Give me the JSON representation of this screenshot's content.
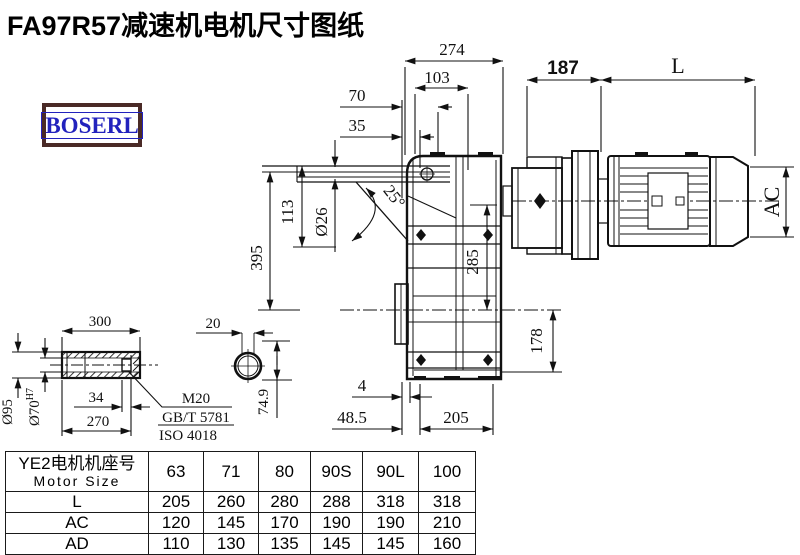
{
  "title": "FA97R57减速机电机尺寸图纸",
  "logo": {
    "text": "BOSERL"
  },
  "dims": {
    "d274": "274",
    "d103": "103",
    "d70": "70",
    "d35": "35",
    "d187": "187",
    "dL": "L",
    "dAC": "AC",
    "d395": "395",
    "d113": "113",
    "d26": "Ø26",
    "d25": "25°",
    "d285": "285",
    "d178": "178",
    "d4": "4",
    "d485": "48.5",
    "d205": "205",
    "d20": "20",
    "d749": "74.9",
    "d300": "300",
    "d95": "Ø95",
    "d70b": "Ø70",
    "d70sup": "H7",
    "d34": "34",
    "d270": "270",
    "m20": "M20",
    "gbt": "GB/T 5781",
    "iso": "ISO 4018"
  },
  "table": {
    "header_cn": "YE2电机机座号",
    "header_en": "Motor Size",
    "sizes": [
      "63",
      "71",
      "80",
      "90S",
      "90L",
      "100"
    ],
    "rows": [
      {
        "label": "L",
        "values": [
          "205",
          "260",
          "280",
          "288",
          "318",
          "318"
        ]
      },
      {
        "label": "AC",
        "values": [
          "120",
          "145",
          "170",
          "190",
          "190",
          "210"
        ]
      },
      {
        "label": "AD",
        "values": [
          "110",
          "130",
          "135",
          "145",
          "145",
          "160"
        ]
      }
    ]
  }
}
